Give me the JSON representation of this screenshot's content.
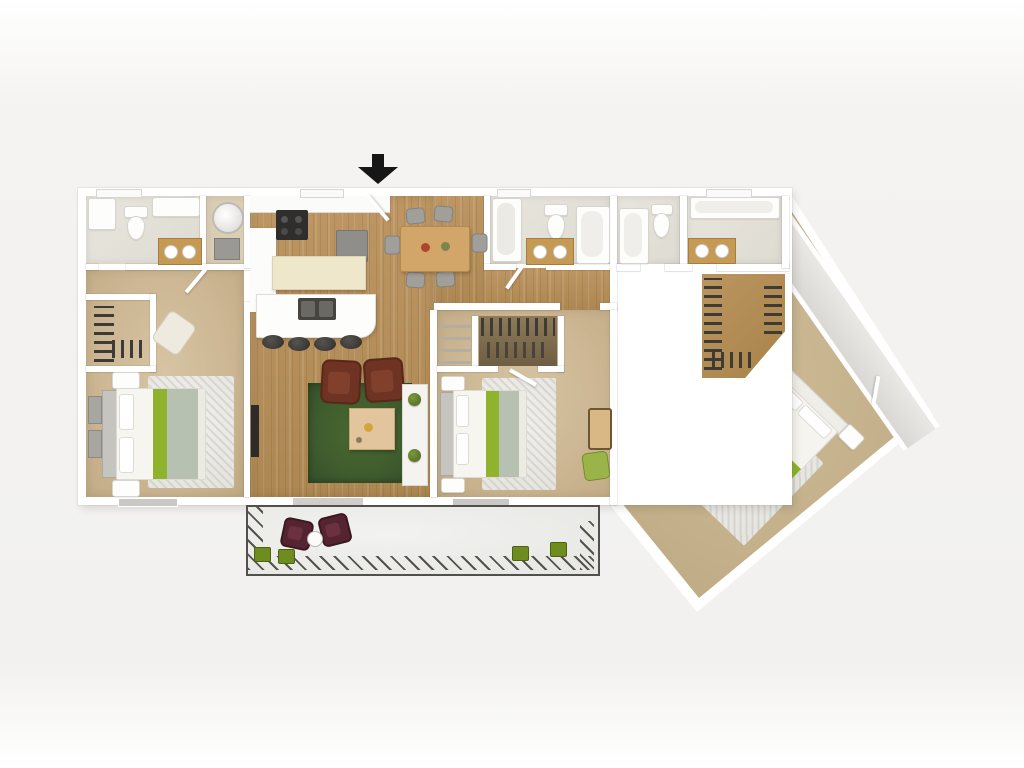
{
  "scene": {
    "kind": "3D floor plan rendering, top-down view",
    "visible_text": "none",
    "entry_marker": "solid black arrow pointing down at the top entrance"
  },
  "palette": {
    "background": "#f2f1ef",
    "wall_white": "#ffffff",
    "wood_floor": "#b5905c",
    "carpet_tan": "#cdb794",
    "master_carpet": "#c3b08a",
    "bath_floor": "#e2dfd6",
    "closet_wood": "#b28d58",
    "living_rug_green": "#3f5c2e",
    "bed_accent_green": "#8fb32c",
    "blanket_sage": "#b6c1b1",
    "armchair_brown": "#6e3322",
    "patio_chair_maroon": "#552431",
    "dining_table_wood": "#d2a569",
    "vanity_wood": "#c49a55",
    "appliance_dark": "#2f2e2c",
    "planter_green": "#6f8d1f",
    "concrete_patio": "#ededeb"
  },
  "rooms": {
    "bathroom_1": {
      "name": "Bathroom 1 (top-left)",
      "fixtures": [
        "shower",
        "toilet",
        "wood vanity with two sinks"
      ]
    },
    "laundry": {
      "name": "Utility closet",
      "fixtures": [
        "washer"
      ]
    },
    "closet_1": {
      "name": "Bedroom 1 walk-in closet",
      "fixtures": [
        "hanging clothes rack"
      ]
    },
    "bedroom_1": {
      "name": "Bedroom 1",
      "furniture": [
        "bed with green accent runner",
        "two nightstands",
        "two dressers",
        "corner accent chair",
        "area rug"
      ]
    },
    "kitchen": {
      "name": "Kitchen",
      "fixtures": [
        "range",
        "refrigerator",
        "cream island",
        "sink counter with breakfast bar",
        "4 bar stools"
      ]
    },
    "dining": {
      "name": "Dining area",
      "furniture": [
        "wood table",
        "6 gray chairs"
      ]
    },
    "living": {
      "name": "Living room",
      "furniture": [
        "TV on wall",
        "green area rug",
        "2 brown armchairs",
        "coffee table",
        "shelf with 2 potted plants"
      ]
    },
    "hallway": {
      "name": "Hallway",
      "floor": "wood"
    },
    "bathroom_2": {
      "name": "Bathroom 2 (hall)",
      "fixtures": [
        "shower",
        "toilet",
        "wood vanity with two sinks",
        "bathtub"
      ]
    },
    "bathroom_3": {
      "name": "Bathroom 3",
      "fixtures": [
        "bathtub",
        "toilet"
      ]
    },
    "master_bathroom": {
      "name": "Master bathroom",
      "fixtures": [
        "bathtub along window wall",
        "wood vanity with two sinks"
      ]
    },
    "bedroom_2": {
      "name": "Bedroom 2",
      "furniture": [
        "bed with green accent runner",
        "two nightstands",
        "area rug",
        "bench",
        "green chair",
        "shelf closet",
        "walk-in closet"
      ]
    },
    "master_closet": {
      "name": "Master walk-in closet",
      "fixtures": [
        "clothes racks on three sides"
      ]
    },
    "master_bedroom": {
      "name": "Master bedroom (angled wing)",
      "furniture": [
        "angled bed with green accent runner",
        "two nightstands",
        "area rug",
        "foot bench",
        "green bench"
      ]
    },
    "balcony": {
      "name": "Angled balcony corridor",
      "fixtures": [
        "door to master bedroom"
      ]
    },
    "patio": {
      "name": "Patio",
      "furniture": [
        "2 maroon chairs",
        "round table",
        "4 green planters"
      ],
      "border": "hatched edge"
    }
  },
  "counts": {
    "bedrooms": 3,
    "bathrooms": 3,
    "bar_stools": 4,
    "dining_chairs": 6,
    "patio_chairs": 2,
    "planters": 4,
    "living_plants": 2
  }
}
